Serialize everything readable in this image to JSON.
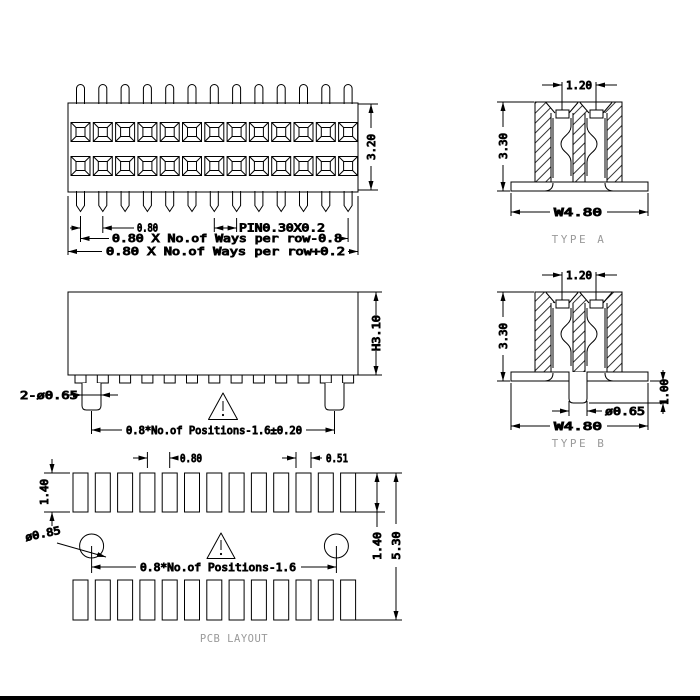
{
  "drawing": {
    "colors": {
      "background": "#ffffff",
      "line": "#000000",
      "muted_label": "#9a9a9a"
    },
    "top_view": {
      "dim_pitch": "0.80",
      "dim_pin": "PIN0.30X0.2",
      "dim_ways_minus": "0.80 X No.of Ways per row-0.8",
      "dim_ways_plus": "0.80 X No.of Ways per row+0.2",
      "dim_height": "3.20"
    },
    "front_view": {
      "dim_pegs": "2-ø0.65",
      "dim_body_height": "H3.10",
      "dim_span": "0.8*No.of Positions-1.6±0.20"
    },
    "type_a": {
      "dim_row_pitch": "1.20",
      "dim_height": "3.30",
      "dim_width": "W4.80",
      "title": "TYPE A"
    },
    "type_b": {
      "dim_row_pitch": "1.20",
      "dim_height": "3.30",
      "dim_peg_length": "1.00",
      "dim_peg_dia": "ø0.65",
      "dim_width": "W4.80",
      "title": "TYPE B"
    },
    "pcb_layout": {
      "dim_pad_height": "1.40",
      "dim_pitch": "0.80",
      "dim_pad_width": "0.51",
      "dim_hole_dia": "ø0.85",
      "dim_span": "0.8*No.of Positions-1.6",
      "dim_row_offset": "1.40",
      "dim_total_height": "5.30",
      "title": "PCB LAYOUT"
    }
  }
}
